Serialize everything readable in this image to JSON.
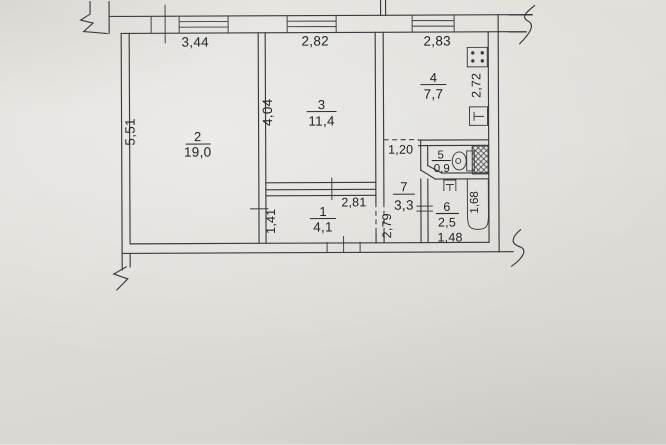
{
  "plan": {
    "title": "apartment-floor-plan",
    "rooms": {
      "room1": {
        "number": "1",
        "area": "4,1"
      },
      "room2": {
        "number": "2",
        "area": "19,0"
      },
      "room3": {
        "number": "3",
        "area": "11,4"
      },
      "room4": {
        "number": "4",
        "area": "7,7"
      },
      "room5": {
        "number": "5",
        "area": "0,9"
      },
      "room6": {
        "number": "6",
        "area": "2,5"
      },
      "room7": {
        "number": "7",
        "area": "3,3"
      }
    },
    "dimensions": {
      "room2_width": "3,44",
      "room3_width": "2,82",
      "room4_width": "2,83",
      "room2_height": "5,51",
      "room3_height": "4,04",
      "kitchen_right_height": "2,72",
      "corridor_width": "1,20",
      "hall_width": "2,81",
      "hall_height": "1,41",
      "corridor_height": "2,79",
      "bathroom_width": "1,48",
      "bathtub_length": "1,68"
    },
    "symbols": [
      "stove",
      "kitchen-sink",
      "toilet",
      "wash-basin",
      "bathtub",
      "ventilation-shaft",
      "window",
      "door-opening"
    ],
    "ink_color": "#3a3a3e",
    "paper_color": "#e0ded9"
  }
}
